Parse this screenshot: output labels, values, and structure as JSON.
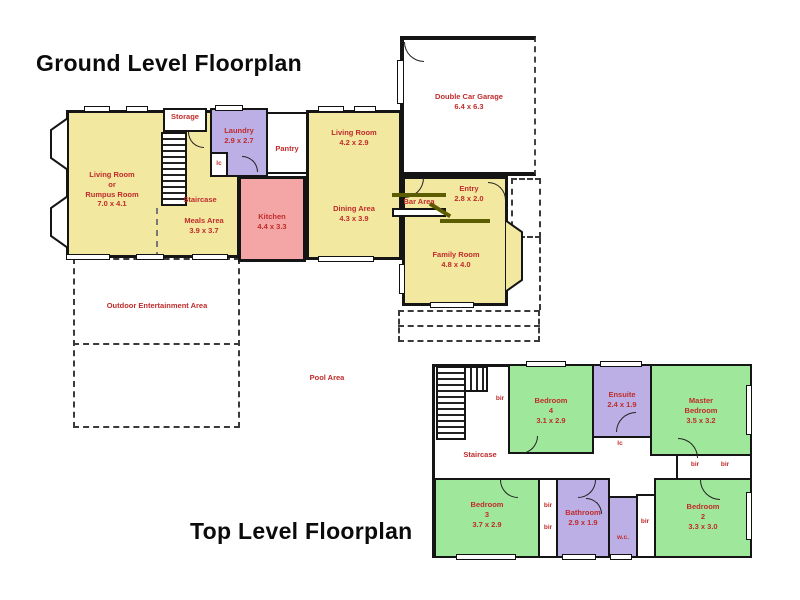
{
  "colors": {
    "yellow": "#F2E8A0",
    "purple": "#BBAFE5",
    "pink": "#F4A6A6",
    "green": "#9FE89B",
    "red": "#C02B2B",
    "wall": "#151515",
    "olive": "#5c5c00"
  },
  "ground": {
    "title": "Ground Level Floorplan",
    "rumpus": {
      "l1": "Living Room",
      "l2": "or",
      "l3": "Rumpus Room",
      "dims": "7.0 x 4.1"
    },
    "storage": {
      "name": "Storage"
    },
    "staircase": {
      "name": "Staircase"
    },
    "laundry": {
      "name": "Laundry",
      "dims": "2.9 x 2.7"
    },
    "lc": "lc",
    "pantry": {
      "name": "Pantry"
    },
    "living": {
      "name": "Living Room",
      "dims": "4.2 x 2.9"
    },
    "garage": {
      "name": "Double Car Garage",
      "dims": "6.4 x 6.3"
    },
    "meals": {
      "name": "Meals Area",
      "dims": "3.9 x 3.7"
    },
    "kitchen": {
      "name": "Kitchen",
      "dims": "4.4 x 3.3"
    },
    "dining": {
      "name": "Dining Area",
      "dims": "4.3 x 3.9"
    },
    "bar": {
      "name": "Bar Area"
    },
    "entry": {
      "name": "Entry",
      "dims": "2.8 x 2.0"
    },
    "family": {
      "name": "Family Room",
      "dims": "4.8 x 4.0"
    },
    "outdoor": {
      "name": "Outdoor Entertainment Area"
    },
    "pool": {
      "name": "Pool Area"
    }
  },
  "top": {
    "title": "Top Level Floorplan",
    "staircase": {
      "name": "Staircase"
    },
    "bed4": {
      "l1": "Bedroom",
      "l2": "4",
      "dims": "3.1 x 2.9"
    },
    "ensuite": {
      "name": "Ensuite",
      "dims": "2.4 x 1.9"
    },
    "master": {
      "l1": "Master",
      "l2": "Bedroom",
      "dims": "3.5 x 3.2"
    },
    "lc": "lc",
    "bed3": {
      "l1": "Bedroom",
      "l2": "3",
      "dims": "3.7 x 2.9"
    },
    "bathroom": {
      "name": "Bathroom",
      "dims": "2.9 x 1.9"
    },
    "wc": "w.c.",
    "bed2": {
      "l1": "Bedroom",
      "l2": "2",
      "dims": "3.3 x 3.0"
    },
    "bir": "bir"
  }
}
